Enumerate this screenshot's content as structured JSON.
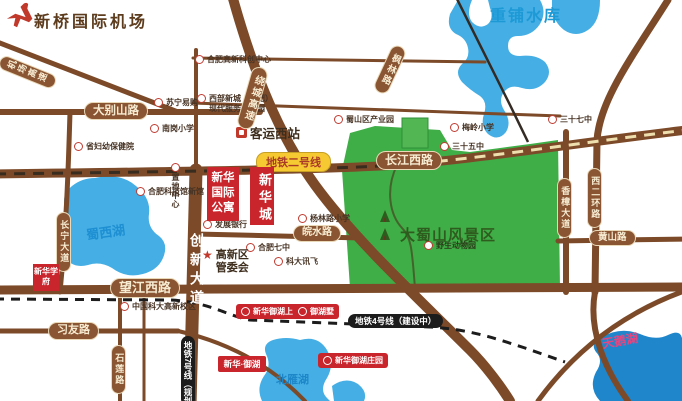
{
  "airport": {
    "label": "新桥国际机场"
  },
  "waters": {
    "chongpu": "重铺水库",
    "shuxihu": "蜀西湖",
    "beiyanhu": "北雁湖",
    "tianehu": "天鹅湖"
  },
  "park": {
    "dashushan": "大蜀山风景区"
  },
  "roads": {
    "dabieshan": "大别山路",
    "changjiangxi": "长江西路",
    "wangjiangxi": "望江西路",
    "xiyou": "习友路",
    "wanshui": "皖水路",
    "huangshan": "黄山路",
    "shilian": "石莲路",
    "raocheng": "绕城高速",
    "jichang": "机场高速",
    "fenglin": "枫林路",
    "chuangxin": "创新大道",
    "changning": "长宁大道",
    "xiangzhang": "香樟大道",
    "xierhuan": "西二环路"
  },
  "metro": {
    "line2": "地铁二号线",
    "line4": "地铁4号线（建设中）",
    "line7": "地铁7号线（规划中）"
  },
  "projects": {
    "xinhua_guoji_gongyu": "新华国际公寓",
    "xinhua_cheng": "新华城",
    "yuhu_shangyuan": "新华御湖上园",
    "yuhu_shu": "御湖墅",
    "yuhu_zhuangyuan": "新华御湖庄园",
    "yuhu_logo": "新华·御湖",
    "xuefu": "新华学府"
  },
  "pois": {
    "suning": "苏宁易购",
    "nangang_xiaoxue": "南岗小学",
    "fuyou_baojian": "省妇幼保健院",
    "keji_guan": "合肥科技馆新馆",
    "zhidi_center": "置地中心",
    "gaoxin_kechuang": "合肥高新科创中心",
    "xibu_xincheng": "西部新城（合肥）现代服务产业园",
    "keyun_xizhan": "客运西站",
    "shushan_chanyeyuan": "蜀山区产业园",
    "meiling_xiaoxue": "梅岭小学",
    "no37": "三十七中",
    "no35": "三十五中",
    "yanglinlu_xiaoxue": "杨林路小学",
    "hefei_qizhong": "合肥七中",
    "kedaxunfei": "科大讯飞",
    "guanweihui": "高新区管委会",
    "zoo": "野生动物园",
    "ustc": "中国科大高新校区",
    "fazhan_bank": "发展银行"
  },
  "colors": {
    "road": "#7c4a28",
    "water": "#45aee4",
    "water_dark": "#1f86cc",
    "park": "#3fae47",
    "landmark_red": "#c9252c",
    "metro_yellow": "#f6c832"
  }
}
